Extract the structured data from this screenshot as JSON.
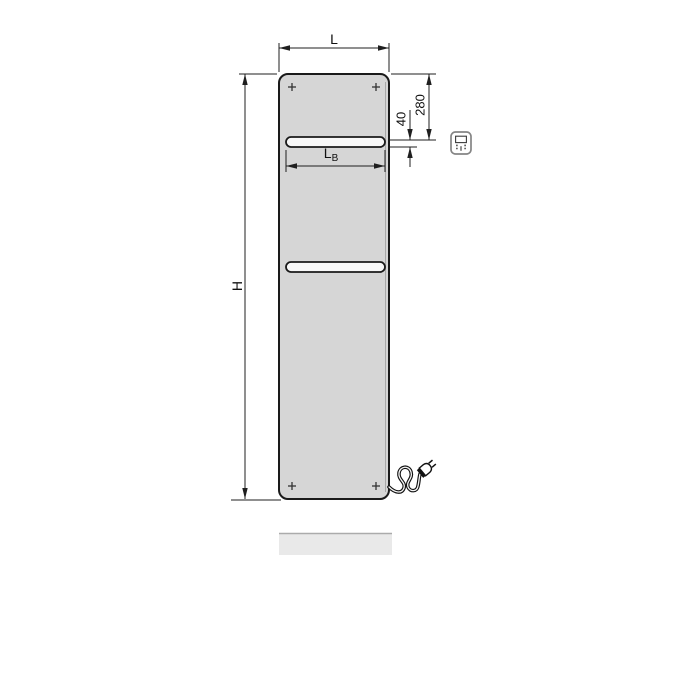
{
  "diagram": {
    "kind": "radiator-dimension-drawing",
    "dim_labels": {
      "width": "L",
      "height": "H",
      "top_offset": "280",
      "slot_height": "40",
      "slot_width_main": "L",
      "slot_width_sub": "B"
    },
    "icons": {
      "controller": "electric-controller-icon",
      "plug": "power-plug-icon",
      "mounting_marks": "plus-mark-icon"
    },
    "colors": {
      "panel_fill": "#d6d6d6",
      "panel_stroke": "#1a1a1a",
      "slot_fill": "#f8f8f8",
      "shadow_fill": "#e9e9e9",
      "shadow_edge": "#ababab",
      "dim_line": "#1f1f1f"
    }
  }
}
